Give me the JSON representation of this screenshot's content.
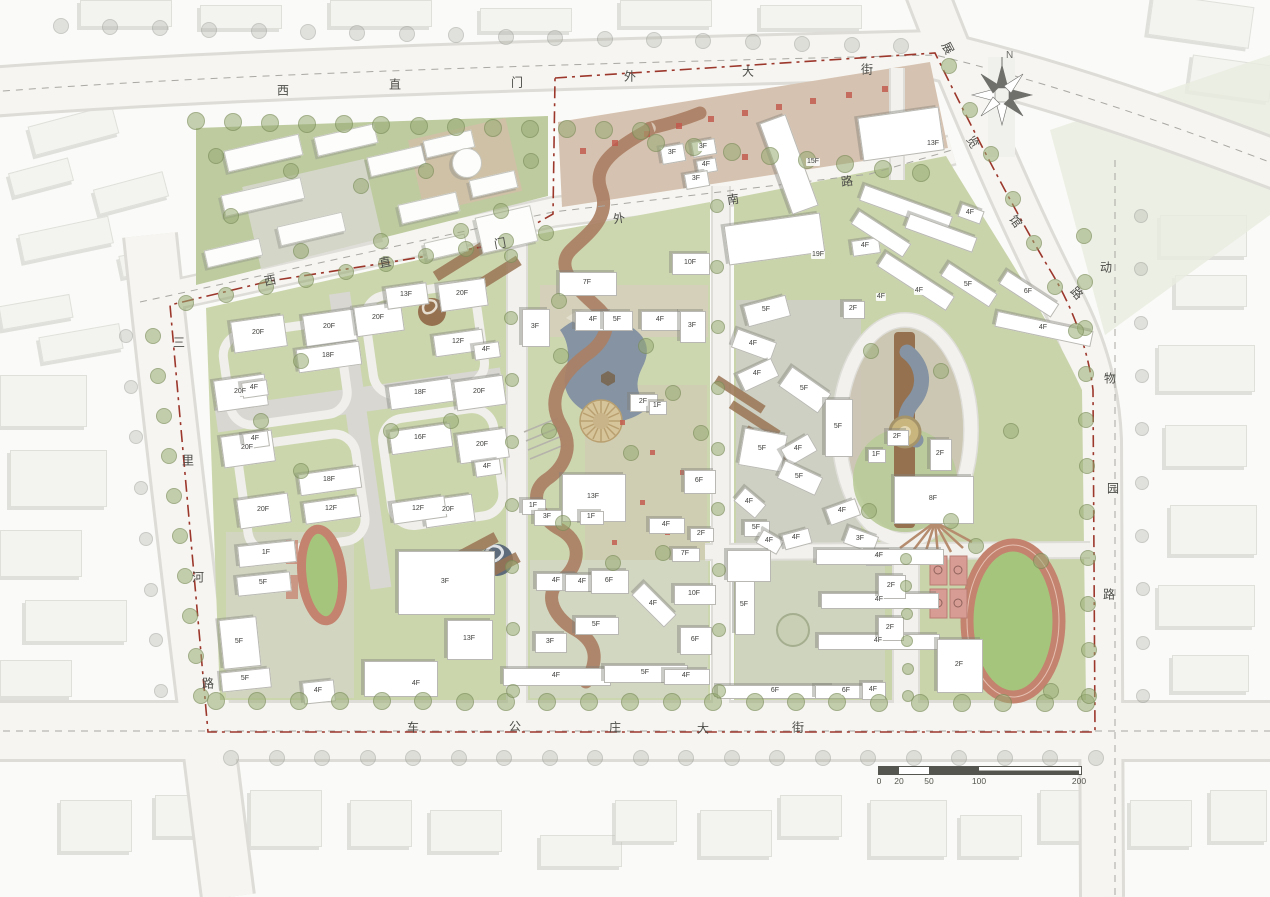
{
  "map": {
    "north_label": "N",
    "streets": [
      {
        "id": "xizhimenwai-dajie",
        "name": "西直门外大街",
        "chars": [
          {
            "t": "西",
            "x": 283,
            "y": 90,
            "r": 0
          },
          {
            "t": "直",
            "x": 395,
            "y": 84,
            "r": 0
          },
          {
            "t": "门",
            "x": 517,
            "y": 82,
            "r": 0
          },
          {
            "t": "外",
            "x": 630,
            "y": 76,
            "r": 0
          },
          {
            "t": "大",
            "x": 748,
            "y": 71,
            "r": 0
          },
          {
            "t": "街",
            "x": 867,
            "y": 69,
            "r": 0
          }
        ]
      },
      {
        "id": "chegongzhuang-dajie",
        "name": "车公庄大街",
        "chars": [
          {
            "t": "车",
            "x": 413,
            "y": 727,
            "r": 0
          },
          {
            "t": "公",
            "x": 515,
            "y": 726,
            "r": 0
          },
          {
            "t": "庄",
            "x": 615,
            "y": 727,
            "r": 0
          },
          {
            "t": "大",
            "x": 703,
            "y": 728,
            "r": 0
          },
          {
            "t": "街",
            "x": 798,
            "y": 727,
            "r": 0
          }
        ]
      },
      {
        "id": "sanlihe-lu",
        "name": "三里河路",
        "chars": [
          {
            "t": "三",
            "x": 179,
            "y": 342,
            "r": 0
          },
          {
            "t": "里",
            "x": 188,
            "y": 460,
            "r": 0
          },
          {
            "t": "河",
            "x": 198,
            "y": 577,
            "r": 0
          },
          {
            "t": "路",
            "x": 208,
            "y": 683,
            "r": 0
          }
        ]
      },
      {
        "id": "dongwuyuan-lu",
        "name": "动物园路",
        "chars": [
          {
            "t": "动",
            "x": 1106,
            "y": 267,
            "r": 0
          },
          {
            "t": "物",
            "x": 1110,
            "y": 378,
            "r": 0
          },
          {
            "t": "园",
            "x": 1113,
            "y": 488,
            "r": 0
          },
          {
            "t": "路",
            "x": 1109,
            "y": 594,
            "r": 0
          }
        ]
      },
      {
        "id": "zhanlanguan-lu",
        "name": "展览馆路",
        "chars": [
          {
            "t": "展",
            "x": 948,
            "y": 48,
            "r": 62
          },
          {
            "t": "览",
            "x": 973,
            "y": 142,
            "r": 60
          },
          {
            "t": "馆",
            "x": 1016,
            "y": 221,
            "r": 55
          },
          {
            "t": "路",
            "x": 1077,
            "y": 293,
            "r": 48
          }
        ]
      },
      {
        "id": "xizhimenwai-nanlu",
        "name": "西直门外南路",
        "chars": [
          {
            "t": "西",
            "x": 270,
            "y": 280,
            "r": -11
          },
          {
            "t": "直",
            "x": 385,
            "y": 262,
            "r": -11
          },
          {
            "t": "门",
            "x": 500,
            "y": 243,
            "r": -10
          },
          {
            "t": "外",
            "x": 619,
            "y": 218,
            "r": -9
          },
          {
            "t": "南",
            "x": 733,
            "y": 199,
            "r": -8
          },
          {
            "t": "路",
            "x": 847,
            "y": 181,
            "r": -8
          }
        ]
      }
    ],
    "building_labels": [
      {
        "t": "13F",
        "x": 406,
        "y": 295
      },
      {
        "t": "20F",
        "x": 462,
        "y": 294
      },
      {
        "t": "20F",
        "x": 378,
        "y": 318
      },
      {
        "t": "20F",
        "x": 329,
        "y": 327
      },
      {
        "t": "20F",
        "x": 258,
        "y": 333
      },
      {
        "t": "12F",
        "x": 458,
        "y": 342
      },
      {
        "t": "4F",
        "x": 486,
        "y": 350
      },
      {
        "t": "18F",
        "x": 328,
        "y": 356
      },
      {
        "t": "4F",
        "x": 254,
        "y": 388
      },
      {
        "t": "20F",
        "x": 240,
        "y": 392
      },
      {
        "t": "18F",
        "x": 420,
        "y": 393
      },
      {
        "t": "20F",
        "x": 479,
        "y": 392
      },
      {
        "t": "4F",
        "x": 255,
        "y": 439
      },
      {
        "t": "20F",
        "x": 247,
        "y": 448
      },
      {
        "t": "16F",
        "x": 420,
        "y": 438
      },
      {
        "t": "20F",
        "x": 482,
        "y": 445
      },
      {
        "t": "4F",
        "x": 487,
        "y": 467
      },
      {
        "t": "18F",
        "x": 329,
        "y": 480
      },
      {
        "t": "20F",
        "x": 263,
        "y": 510
      },
      {
        "t": "12F",
        "x": 331,
        "y": 509
      },
      {
        "t": "12F",
        "x": 418,
        "y": 509
      },
      {
        "t": "20F",
        "x": 448,
        "y": 510
      },
      {
        "t": "1F",
        "x": 266,
        "y": 553
      },
      {
        "t": "5F",
        "x": 263,
        "y": 583
      },
      {
        "t": "5F",
        "x": 239,
        "y": 642
      },
      {
        "t": "5F",
        "x": 245,
        "y": 679
      },
      {
        "t": "4F",
        "x": 318,
        "y": 691
      },
      {
        "t": "13F",
        "x": 469,
        "y": 639
      },
      {
        "t": "3F",
        "x": 445,
        "y": 582
      },
      {
        "t": "4F",
        "x": 416,
        "y": 684
      },
      {
        "t": "10F",
        "x": 690,
        "y": 263
      },
      {
        "t": "7F",
        "x": 587,
        "y": 283
      },
      {
        "t": "4F",
        "x": 593,
        "y": 320
      },
      {
        "t": "5F",
        "x": 617,
        "y": 320
      },
      {
        "t": "4F",
        "x": 660,
        "y": 320
      },
      {
        "t": "3F",
        "x": 535,
        "y": 327
      },
      {
        "t": "3F",
        "x": 692,
        "y": 326
      },
      {
        "t": "2F",
        "x": 643,
        "y": 402
      },
      {
        "t": "1F",
        "x": 657,
        "y": 406
      },
      {
        "t": "13F",
        "x": 593,
        "y": 497
      },
      {
        "t": "1F",
        "x": 533,
        "y": 506
      },
      {
        "t": "3F",
        "x": 547,
        "y": 517
      },
      {
        "t": "1F",
        "x": 591,
        "y": 517
      },
      {
        "t": "4F",
        "x": 556,
        "y": 581
      },
      {
        "t": "4F",
        "x": 582,
        "y": 582
      },
      {
        "t": "6F",
        "x": 609,
        "y": 581
      },
      {
        "t": "5F",
        "x": 596,
        "y": 625
      },
      {
        "t": "3F",
        "x": 550,
        "y": 642
      },
      {
        "t": "4F",
        "x": 653,
        "y": 604
      },
      {
        "t": "10F",
        "x": 694,
        "y": 594
      },
      {
        "t": "6F",
        "x": 695,
        "y": 640
      },
      {
        "t": "4F",
        "x": 556,
        "y": 676
      },
      {
        "t": "5F",
        "x": 645,
        "y": 673
      },
      {
        "t": "4F",
        "x": 686,
        "y": 676
      },
      {
        "t": "4F",
        "x": 666,
        "y": 525
      },
      {
        "t": "2F",
        "x": 701,
        "y": 534
      },
      {
        "t": "7F",
        "x": 685,
        "y": 554
      },
      {
        "t": "6F",
        "x": 699,
        "y": 481
      },
      {
        "t": "5F",
        "x": 766,
        "y": 310
      },
      {
        "t": "2F",
        "x": 853,
        "y": 309
      },
      {
        "t": "4F",
        "x": 753,
        "y": 344
      },
      {
        "t": "4F",
        "x": 757,
        "y": 374
      },
      {
        "t": "5F",
        "x": 804,
        "y": 389
      },
      {
        "t": "5F",
        "x": 838,
        "y": 427
      },
      {
        "t": "5F",
        "x": 762,
        "y": 449
      },
      {
        "t": "4F",
        "x": 798,
        "y": 449
      },
      {
        "t": "5F",
        "x": 799,
        "y": 477
      },
      {
        "t": "1F",
        "x": 876,
        "y": 455
      },
      {
        "t": "2F",
        "x": 897,
        "y": 437
      },
      {
        "t": "2F",
        "x": 940,
        "y": 454
      },
      {
        "t": "8F",
        "x": 933,
        "y": 499
      },
      {
        "t": "4F",
        "x": 749,
        "y": 502
      },
      {
        "t": "4F",
        "x": 842,
        "y": 511
      },
      {
        "t": "5F",
        "x": 756,
        "y": 528
      },
      {
        "t": "4F",
        "x": 769,
        "y": 541
      },
      {
        "t": "4F",
        "x": 796,
        "y": 538
      },
      {
        "t": "3F",
        "x": 860,
        "y": 539
      },
      {
        "t": "4F",
        "x": 878,
        "y": 557
      },
      {
        "t": "3F",
        "x": 672,
        "y": 153
      },
      {
        "t": "3F",
        "x": 703,
        "y": 147
      },
      {
        "t": "4F",
        "x": 706,
        "y": 165
      },
      {
        "t": "3F",
        "x": 696,
        "y": 179
      },
      {
        "t": "15F",
        "x": 813,
        "y": 162
      },
      {
        "t": "13F",
        "x": 933,
        "y": 144
      },
      {
        "t": "19F",
        "x": 818,
        "y": 255
      },
      {
        "t": "4F",
        "x": 865,
        "y": 246
      },
      {
        "t": "4F",
        "x": 970,
        "y": 213
      },
      {
        "t": "4F",
        "x": 919,
        "y": 291
      },
      {
        "t": "4F",
        "x": 881,
        "y": 297
      },
      {
        "t": "5F",
        "x": 968,
        "y": 285
      },
      {
        "t": "6F",
        "x": 1028,
        "y": 292
      },
      {
        "t": "4F",
        "x": 1043,
        "y": 328
      },
      {
        "t": "4F",
        "x": 879,
        "y": 556
      },
      {
        "t": "2F",
        "x": 891,
        "y": 586
      },
      {
        "t": "4F",
        "x": 879,
        "y": 600
      },
      {
        "t": "2F",
        "x": 890,
        "y": 628
      },
      {
        "t": "4F",
        "x": 878,
        "y": 641
      },
      {
        "t": "2F",
        "x": 959,
        "y": 665
      },
      {
        "t": "5F",
        "x": 744,
        "y": 605
      },
      {
        "t": "6F",
        "x": 775,
        "y": 691
      },
      {
        "t": "6F",
        "x": 846,
        "y": 691
      },
      {
        "t": "4F",
        "x": 873,
        "y": 690
      }
    ],
    "scale_bar": {
      "ticks": [
        {
          "label": "0",
          "offset": 0
        },
        {
          "label": "20",
          "offset": 20
        },
        {
          "label": "50",
          "offset": 50
        },
        {
          "label": "100",
          "offset": 100
        },
        {
          "label": "200",
          "offset": 200
        }
      ]
    }
  },
  "colors": {
    "boundary_red": "#9c372c",
    "site_green": "#cbd6ad",
    "park_green": "#bdcb9f",
    "road_white": "#f6f5f1",
    "paving_gray": "#d8d7d1",
    "plaza_tan": "#d6c2b0",
    "wood_brown": "#96714f",
    "water_blue": "#8593a2",
    "track_red": "#c3836f",
    "infield_green": "#a6c57c",
    "court_pink": "#d79d95",
    "accent_red": "#c2574b"
  }
}
